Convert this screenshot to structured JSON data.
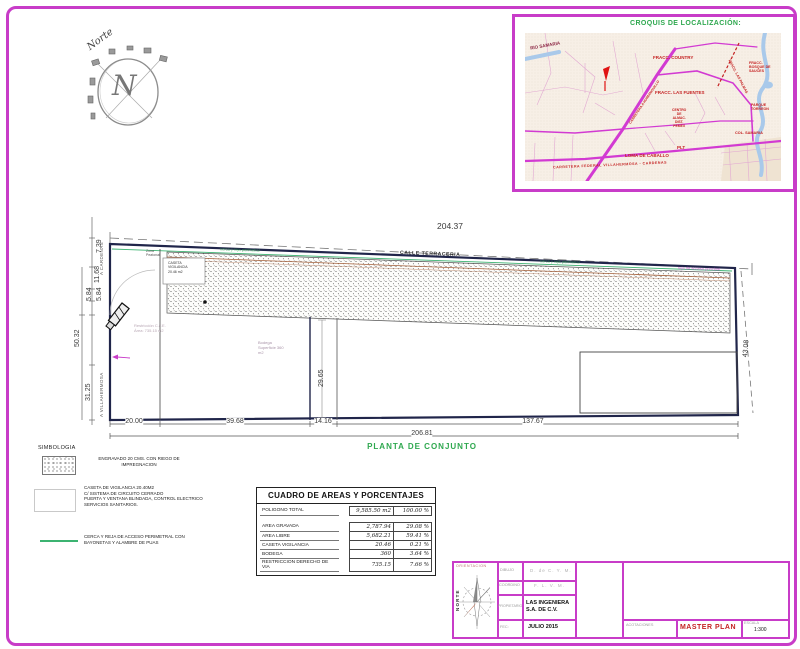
{
  "north": {
    "label": "Norte",
    "letter": "N"
  },
  "croquis": {
    "title": "CROQUIS DE LOCALIZACIÓN:",
    "labels": {
      "rio": "RIO SAMARIA",
      "country": "FRACC. COUNTRY",
      "bosques": "FRACC.\nBOSQUE DE\nSAUCES",
      "palmas": "FRACC. LAS PALMAS",
      "fuentes": "FRACC. LAS FUENTES",
      "parque": "PARQUE\nTORREON",
      "centro": "CENTRO\nDE\nALMAC.\nDIST.\nPEMEX",
      "plt": "PLT",
      "loma": "LOMA DE CABALLO",
      "col": "COL. SAMARIA",
      "carretera": "CARRETERA FEDERAL VILLAHERMOSA - CARDENAS",
      "diagonal": "CARRETERA A HUIMANGUILLO"
    }
  },
  "plan": {
    "title": "PLANTA DE CONJUNTO",
    "calle_top": "CALLE TERRACERIA",
    "road_left_top": "A CARDENAS",
    "road_left_bottom": "A VILLAHERMOSA",
    "dim_top": "204.37",
    "dim_right": "43.08",
    "dim_inner": "29.65",
    "dims_left": [
      "7.39",
      "11.68",
      "5.84",
      "5.84",
      "50.32",
      "31.25"
    ],
    "dims_bottom": [
      "20.00",
      "39.68",
      "14.16",
      "137.67"
    ],
    "dim_total": "206.81",
    "caseta": "CASETA\nVIGILANCIA\n20.46 m2",
    "zona": "Zona\nPeatonal",
    "bodega": "Bodega\nSuperficie 360\nm2",
    "restriccion": "Restricción C.F.E.\nÁrea: 735.15 m2",
    "fence_a": "cerca y reja perimetral",
    "fence_b": "cerca y reja perimetral",
    "fence_c": "reja de acceso principal"
  },
  "simbologia": {
    "title": "SIMBOLOGIA",
    "item1": "ENGRAVADO 20 CMS. CON RIEGO DE\nIMPREGNACION",
    "item2": "CASETA DE VIGILANCIA 20.40M2\nC/ SISTEMA DE CIRCUITO CERRADO\nPUERTA Y VENTANA BLINDADA, CONTROL ELECTRICO\nSERVICIOS SANITARIOS.",
    "item3": "CERCA Y REJA DE ACCESO PERIMETRAL CON\nBAYONETAS Y ALAMBRE DE PUAS"
  },
  "cuadro": {
    "title": "CUADRO DE AREAS Y PORCENTAJES",
    "rows": [
      {
        "label": "POLIGONO TOTAL",
        "value": "9,585.50 m2",
        "pct": "100.00 %"
      },
      {
        "label": "AREA GRAVADA",
        "value": "2,787.94",
        "pct": "29.08 %"
      },
      {
        "label": "AREA LIBRE",
        "value": "5,682.21",
        "pct": "59.41 %"
      },
      {
        "label": "CASETA VIGILANCIA",
        "value": "20.46",
        "pct": "0.21 %"
      },
      {
        "label": "BODEGA",
        "value": "360",
        "pct": "3.64 %"
      },
      {
        "label": "RESTRICCION DERECHO DE VIA",
        "value": "735.15",
        "pct": "7.66 %"
      }
    ]
  },
  "titleblock": {
    "orientacion": "ORIENTACION",
    "norte": "NORTE",
    "rows": [
      {
        "label": "DIBUJO",
        "value": "D. de C. Y. M."
      },
      {
        "label": "COORDINO",
        "value": "F. L. V. M."
      },
      {
        "label": "PROPIETARIO",
        "value": "LAS INGENIERA\nS.A. DE C.V."
      },
      {
        "label": "FEC:",
        "value": "JULIO 2015"
      }
    ],
    "acotaciones": "ACOTACIONES",
    "plan_name": "MASTER PLAN",
    "escala_label": "ESCALA",
    "escala_value": "1:300"
  },
  "colors": {
    "magenta": "#c83cc8",
    "green": "#2fa84f",
    "red": "#c42222"
  }
}
